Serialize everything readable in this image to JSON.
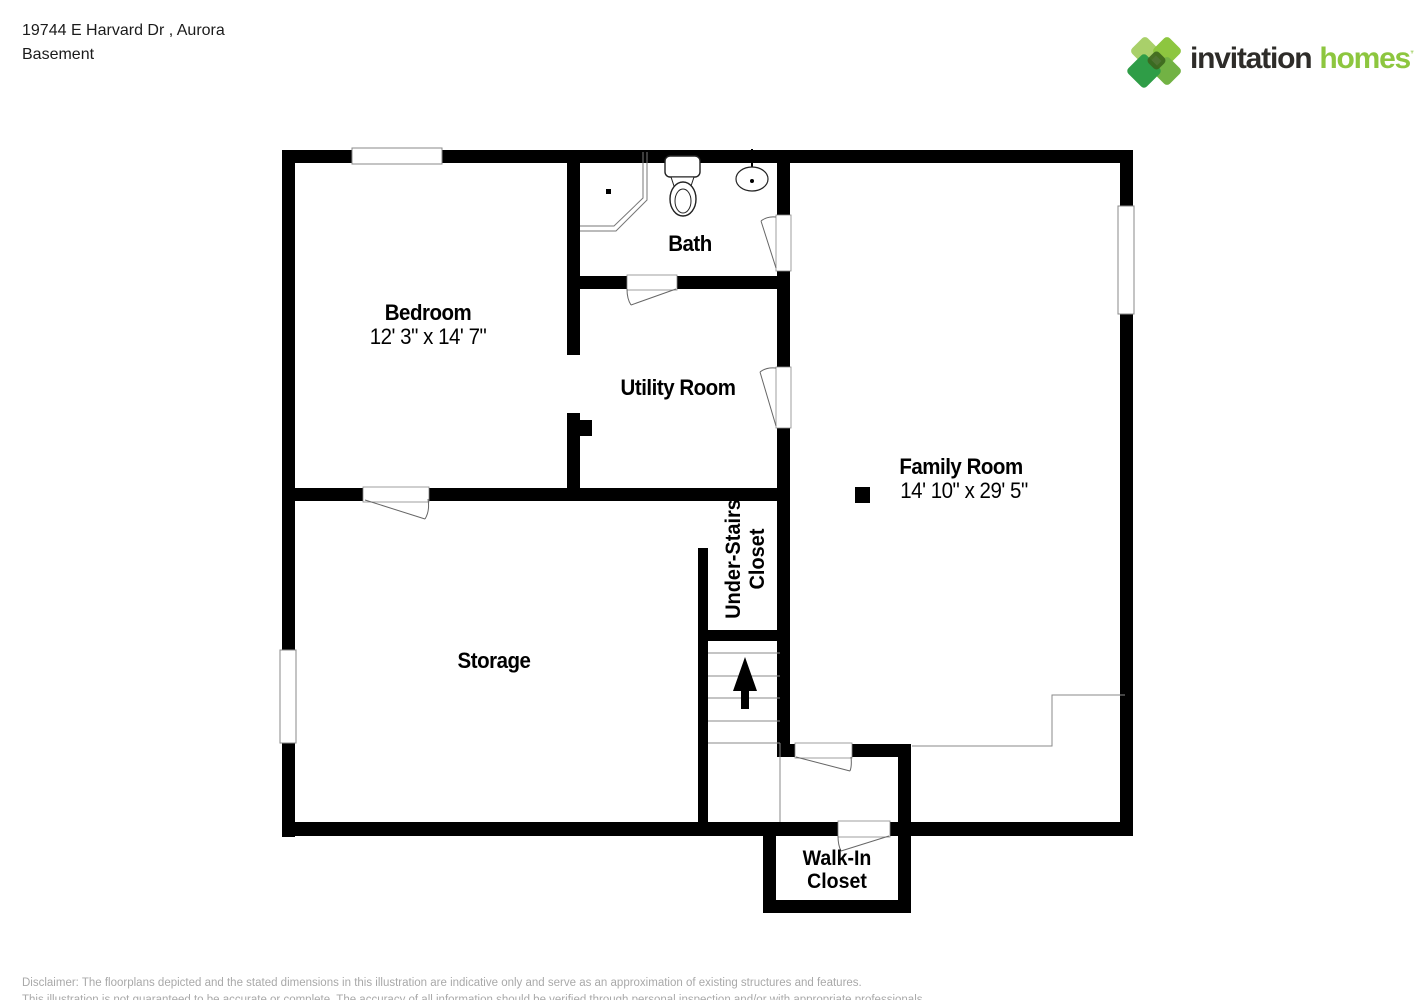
{
  "header": {
    "address": "19744 E Harvard Dr , Aurora",
    "level": "Basement"
  },
  "logo": {
    "brand_part1": "invitation",
    "brand_part2": "homes",
    "trademark": "™",
    "colors": {
      "brand_dark": "#2e2c29",
      "brand_green": "#8dc63f",
      "diamond_light": "#a9d06a",
      "diamond_medium": "#8dc63f",
      "diamond_mid": "#72b244",
      "diamond_dark": "#2f9d47",
      "diamond_center": "#3c651d"
    }
  },
  "floorplan": {
    "wall_color": "#000000",
    "door_line_color": "#666666",
    "rooms": {
      "bedroom": {
        "label": "Bedroom",
        "dims": "12' 3\" x 14' 7\""
      },
      "bath": {
        "label": "Bath"
      },
      "utility": {
        "label": "Utility Room"
      },
      "family": {
        "label": "Family Room",
        "dims": "14' 10\" x 29' 5\""
      },
      "under_stairs": {
        "label_line1": "Under-Stairs",
        "label_line2": "Closet"
      },
      "storage": {
        "label": "Storage"
      },
      "walk_in": {
        "label_line1": "Walk-In",
        "label_line2": "Closet"
      }
    }
  },
  "disclaimer": {
    "line1": "Disclaimer: The floorplans depicted and the stated dimensions in this illustration are indicative only and serve as an approximation of existing structures and features.",
    "line2": "This illustration is not guaranteed to be accurate or complete. The accuracy of all information should be verified through personal inspection and/or with appropriate professionals."
  }
}
